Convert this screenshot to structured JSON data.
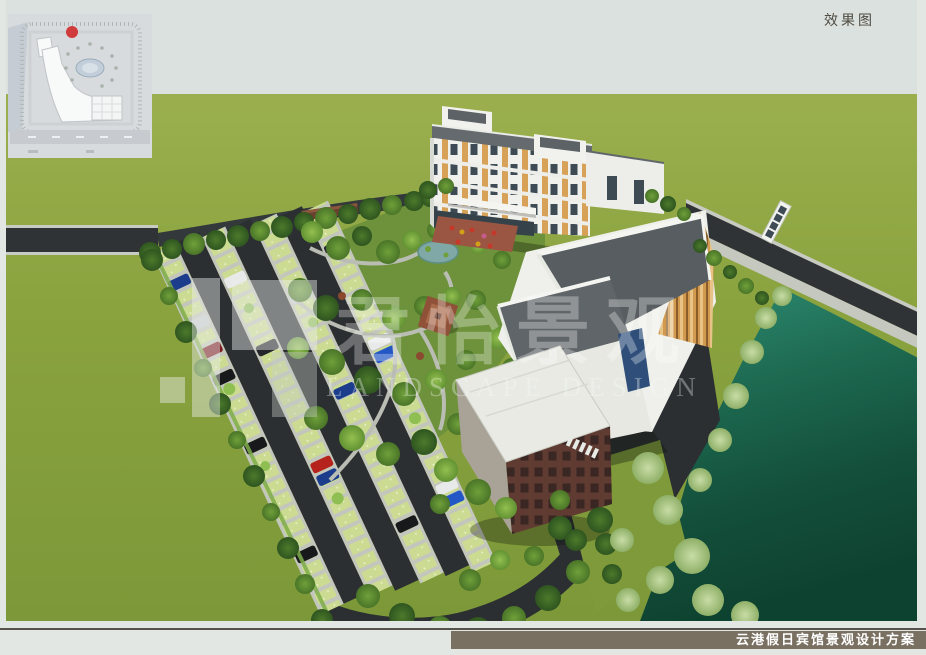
{
  "header": {
    "label": "效果图"
  },
  "watermark": {
    "cn": "君怡景观",
    "en": "LANDSCAPE DESIGN"
  },
  "footer": {
    "title": "云港假日宾馆景观设计方案",
    "bar_color": "#7A7062",
    "rule_color": "#54524B"
  },
  "inset_map": {
    "description": "site-plan-thumbnail",
    "marker_color": "#D03C3C",
    "paper_color": "#D7DBDE"
  },
  "scene": {
    "labels": {
      "hotel": "hotel-main-building",
      "podium": "front-podium-building",
      "brick": "brick-utility-building",
      "parking": "parking-lot",
      "garden": "central-garden",
      "pond": "garden-pond",
      "pavilion": "garden-pavilion",
      "water": "river-pond",
      "bridge": "footbridge"
    },
    "colors": {
      "sky": "#DBE1DE",
      "grass_field": "#8AA33F",
      "garden_grass": "#6E923B",
      "asphalt": "#2B2F31",
      "stall_concrete": "#C2C6BC",
      "stall_grass_paver": "#CBDC92",
      "water_top": "#2F8E74",
      "water_deep": "#0E4230",
      "building_white": "#EFF0EB",
      "roof_gray": "#575D61",
      "facade_orange": "#D8A158",
      "brick_wall": "#5F3B31",
      "pavilion_roof": "#8F5138"
    }
  }
}
